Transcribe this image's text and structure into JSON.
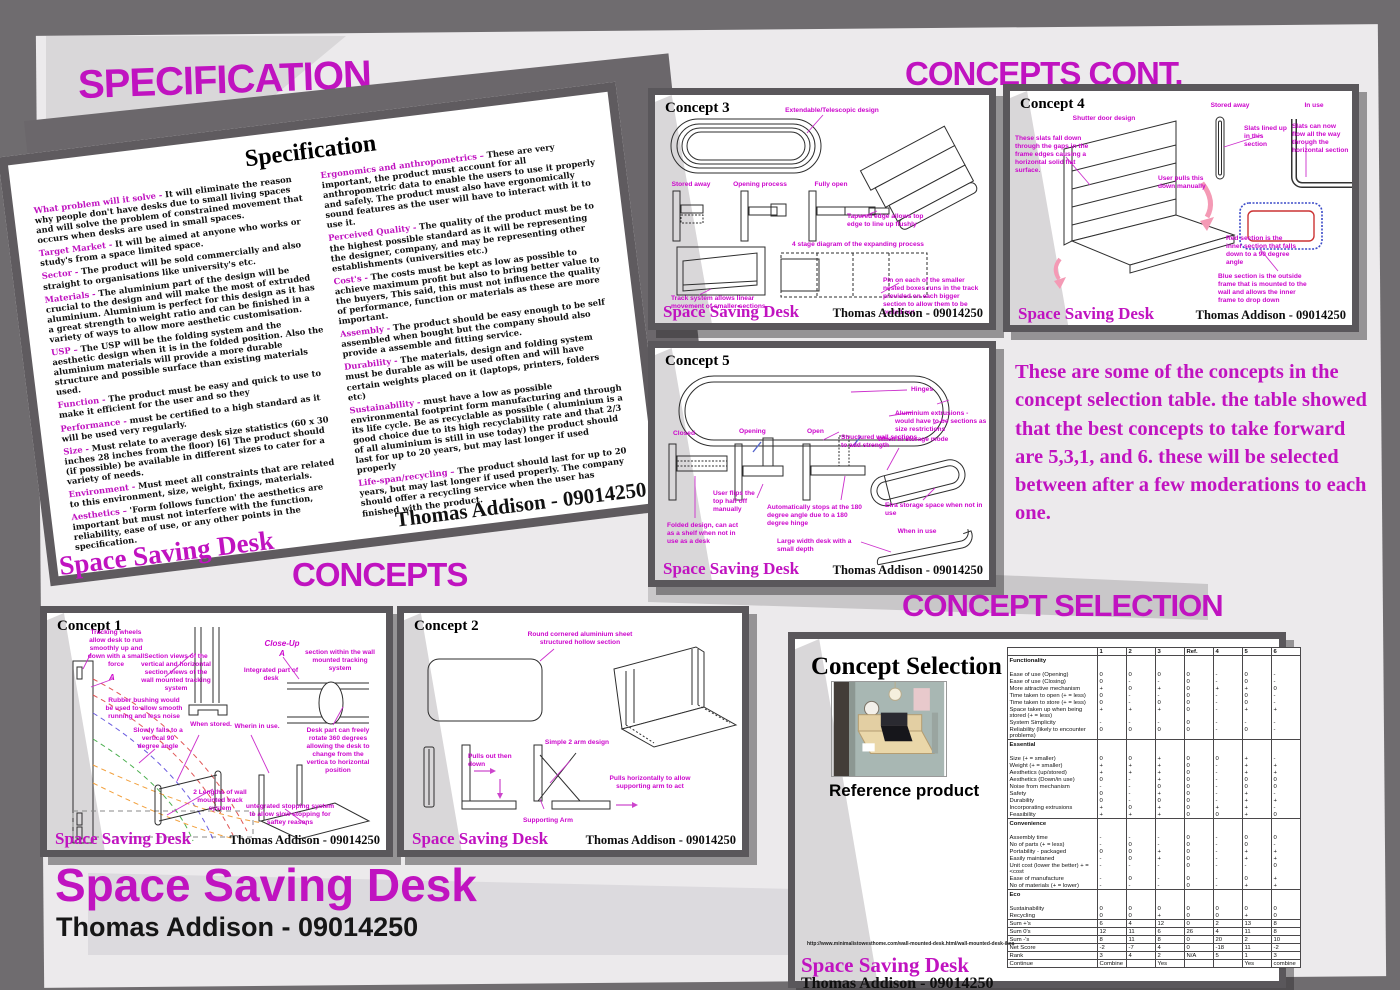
{
  "headings": {
    "specification": "SPECIFICATION",
    "concepts_cont": "CONCEPTS CONT.",
    "concepts": "CONCEPTS",
    "concept_selection": "CONCEPT SELECTION"
  },
  "poster": {
    "title": "Space Saving Desk",
    "author": "Thomas Addison - 09014250"
  },
  "panel_footer": {
    "brand": "Space Saving Desk",
    "author": "Thomas Addison - 09014250"
  },
  "colors": {
    "magenta": "#c013c0",
    "panel_border": "#5a575b",
    "background": "#6f6c6f",
    "sheet": "#eceaec"
  },
  "note": "These are some of the concepts in the concept selection table. the table showed that the best concepts to take forward are 5,3,1, and 6. these will be selected between after a few moderations to each one.",
  "spec_doc": {
    "title": "Specification",
    "left_items": [
      {
        "k": "What problem will it solve -",
        "t": "It will eliminate the reason why people don't have desks due to small living spaces and will solve the problem of constrained movement that occurs when desks are used in small spaces."
      },
      {
        "k": "Target Market -",
        "t": "It will be aimed at anyone who works or study's from a space limited space."
      },
      {
        "k": "Sector -",
        "t": "The product will be sold commercially and also straight to organisations like university's etc."
      },
      {
        "k": "Materials -",
        "t": "The aluminium part of the design will be crucial to the design and will make the most of extruded aluminium. Aluminium is perfect for this design as it has a great strength to weight ratio and can be finished in a variety of ways to allow more aesthetic customisation."
      },
      {
        "k": "USP –",
        "t": "The USP will be the folding system and the aesthetic design when it is in the folded position. Also the aluminium materials will provide a more durable structure and possible surface than existing materials used."
      },
      {
        "k": "Function -",
        "t": "The product must be easy and quick to use to make it efficient for the user and so they"
      },
      {
        "k": "Performance -",
        "t": "must be certified to a high standard as it will be used very regularly."
      },
      {
        "k": "Size -",
        "t": "Must relate to average desk size statistics (60 x 30 inches 28 inches from the floor) [6] The product should (if possible) be available in different sizes to cater for a variety of needs."
      },
      {
        "k": "Environment -",
        "t": "Must meet all constraints that are related to this environment, size, weight, fixings, materials."
      },
      {
        "k": "Aesthetics –",
        "t": "'Form follows function' the aesthetics are important but must not interfere with the function, reliability, ease of use, or any other points in the specification."
      }
    ],
    "right_items": [
      {
        "k": "Ergonomics and anthropometrics –",
        "t": "These are very important, the product must account for all anthropometric data to enable the users to use it properly and safely. The product must also have ergonomically sound features as the user will have to interact with it to use it."
      },
      {
        "k": "Perceived Quality -",
        "t": "The quality of the product must be to the highest possible standard as it will be representing the designer, company, and may be representing other establishments (universities etc.)"
      },
      {
        "k": "Cost's -",
        "t": "The costs must be kept as low as possible to achieve maximum profit but also to bring better value to the buyers, This said, this must not influence the quality of performance, function or materials as these are more important."
      },
      {
        "k": "Assembly -",
        "t": "The product should be easy enough to be self assembled when bought but the company should also provide a assemble and fitting service."
      },
      {
        "k": "Durability -",
        "t": "The materials, design and folding system must be durable as will be used often and will have certain weights placed on it (laptops, printers, folders etc)"
      },
      {
        "k": "Sustainability -",
        "t": "must have a low as possible environmental footprint form manufacturing and through its life cycle. Be as recyclable as possible ( aluminium is a good choice due to its high recyclability rate and that 2/3 of all aluminium is still in use today) the product should last for up to 20 years, but may last longer if used properly"
      },
      {
        "k": "Life-span/recycling –",
        "t": "The product should last for up to 20 years, but may last longer if used properly. The company should offer a recycling service when the user has finished with the product."
      }
    ]
  },
  "concept1": {
    "title": "Concept 1",
    "tracking": "Tracking wheels allow desk to run smoothly up and down with a small force",
    "a_label": "A",
    "rubber": "Rubber bushing would be used to allow smooth running and less noise",
    "falls": "Slowly falls to a vertical 90 degree angle",
    "section_views": "Section views of the vertical and horizontal section views of the wall mounted tracking system",
    "stored": "When stored.",
    "closeup1": "Close-Up",
    "closeup2": "A",
    "within": "section within the wall mounted tracking system",
    "integrated": "Integrated part of desk",
    "inuse": "Wherin in use.",
    "rotate": "Desk part can freely rotate 360 degrees allowing the desk to change from the vertica to horizontal position",
    "lengths": "2 Lengths of wall mounted track system",
    "stopping": "untegrated stopping system to allow slow stopping for saftey reasons"
  },
  "concept2": {
    "title": "Concept 2",
    "sheet": "Round cornered aluminium sheet structured hollow section",
    "pulls": "Pulls out then down",
    "simple": "Simple 2 arm design",
    "supporting": "Supporting Arm",
    "horizontally": "Pulls horizontally to allow supporting arm to act"
  },
  "concept3": {
    "title": "Concept 3",
    "extendable": "Extendable/Telescopic design",
    "stored": "Stored away",
    "opening": "Opening process",
    "fully": "Fully open",
    "tapered": "Tapered edge allows top edge to line up flushly",
    "stage4": "4 stage diagram of the expanding process",
    "track": "Track system allows linear movement of smaller sections",
    "pin": "Pin on each of the smaller nested boxes runs in the track provided on each bigger section to allow them to be pulled out"
  },
  "concept4": {
    "title": "Concept 4",
    "shutter": "Shutter door design",
    "slats_fall": "These slats fall down through the gaps in the frame edges causing a horizontal solid flat surface.",
    "stored": "Stored away",
    "inuse": "In use",
    "slats_lined": "Slats lined up in this section",
    "slats_flow": "Slats can now flow all the way through the horizontal section",
    "user_pulls": "User pulls this down manually",
    "red_section": "Red section is the inner section that falls down to a 90 degree angle",
    "blue_section": "Blue section is the outside frame that is mounted to the wall and allows the inner frame to drop down"
  },
  "concept5": {
    "title": "Concept 5",
    "hinges": "Hinges",
    "extrusions": "Aluminium extrusions - would have to be sections as size restrictions",
    "structured": "Structured wall sections to add strength",
    "closed": "Closed",
    "opening": "Opening",
    "open": "Open",
    "flips": "User flips the top half off manually",
    "stops": "Automatically stops at the 180 degree angle due to a 180 degree hinge",
    "folded": "Folded design, can act as a shelf when not in use as a desk",
    "storage": "When in storage mode",
    "extra": "Etra storage space when not in use",
    "inuse": "When in use",
    "width": "Large width desk with a small depth"
  },
  "selection": {
    "title": "Concept Selection",
    "caption": "Reference product",
    "url": "http://www.minimalistowesthome.com/wall-mounted-desk.html/wall-mounted-desk-ikea",
    "table": {
      "columns": [
        "1",
        "2",
        "3",
        "Ref.",
        "4",
        "5",
        "6"
      ],
      "sections": [
        {
          "name": "Functionality",
          "rows": [
            {
              "label": "Ease of use (Opening)",
              "values": [
                "0",
                "0",
                "0",
                "0",
                "-",
                "0",
                "-"
              ]
            },
            {
              "label": "Ease of use (Closing)",
              "values": [
                "0",
                "-",
                "-",
                "0",
                "-",
                "0",
                "-"
              ]
            },
            {
              "label": "More attractive mechanism",
              "values": [
                "+",
                "0",
                "+",
                "0",
                "+",
                "+",
                "0"
              ]
            },
            {
              "label": "Time taken to open (+ = less)",
              "values": [
                "0",
                "-",
                "-",
                "0",
                "-",
                "0",
                "-"
              ]
            },
            {
              "label": "Time taken to store (+ = less)",
              "values": [
                "0",
                "-",
                "0",
                "0",
                "-",
                "0",
                "-"
              ]
            },
            {
              "label": "Space taken up when being stored (+ = less)",
              "values": [
                "+",
                "+",
                "+",
                "0",
                "-",
                "+",
                "+"
              ]
            },
            {
              "label": "System Simplicity",
              "values": [
                "-",
                "-",
                "-",
                "0",
                "-",
                "-",
                "-"
              ]
            },
            {
              "label": "Reliability (likely to encounter problems)",
              "values": [
                "0",
                "0",
                "0",
                "0",
                "-",
                "0",
                "-"
              ]
            }
          ]
        },
        {
          "name": "Essential",
          "rows": [
            {
              "label": "Size (+ = smaller)",
              "values": [
                "0",
                "0",
                "+",
                "0",
                "0",
                "+",
                "-"
              ]
            },
            {
              "label": "Weight (+ = smaller)",
              "values": [
                "+",
                "+",
                "+",
                "0",
                "-",
                "+",
                "+"
              ]
            },
            {
              "label": "Aesthetics (up/stored)",
              "values": [
                "+",
                "+",
                "+",
                "0",
                "-",
                "+",
                "+"
              ]
            },
            {
              "label": "Aesthetics (Down/in use)",
              "values": [
                "0",
                "-",
                "+",
                "0",
                "-",
                "0",
                "0"
              ]
            },
            {
              "label": "Noise from mechanism",
              "values": [
                "-",
                "-",
                "0",
                "0",
                "-",
                "0",
                "0"
              ]
            },
            {
              "label": "Safety",
              "values": [
                "0",
                "-",
                "+",
                "0",
                "-",
                "+",
                "-"
              ]
            },
            {
              "label": "Durability",
              "values": [
                "0",
                "-",
                "0",
                "0",
                "-",
                "+",
                "+"
              ]
            },
            {
              "label": "Incorporating extrusions",
              "values": [
                "+",
                "0",
                "+",
                "0",
                "+",
                "+",
                "-"
              ]
            },
            {
              "label": "Feasibility",
              "values": [
                "+",
                "+",
                "+",
                "0",
                "0",
                "+",
                "0"
              ]
            }
          ]
        },
        {
          "name": "Convenience",
          "rows": [
            {
              "label": "Assembly time",
              "values": [
                "-",
                "-",
                "-",
                "0",
                "-",
                "0",
                "0"
              ]
            },
            {
              "label": "No of parts (+ = less)",
              "values": [
                "-",
                "0",
                "-",
                "0",
                "-",
                "0",
                "-"
              ]
            },
            {
              "label": "Portability - packaged",
              "values": [
                "0",
                "0",
                "+",
                "0",
                "-",
                "+",
                "+"
              ]
            },
            {
              "label": "Easily maintaned",
              "values": [
                "-",
                "0",
                "+",
                "0",
                "-",
                "+",
                "+"
              ]
            },
            {
              "label": "Unit cost (lower the better) + = <cost",
              "values": [
                "-",
                "-",
                "-",
                "0",
                "-",
                "-",
                "0"
              ]
            },
            {
              "label": "Ease of manufacture",
              "values": [
                "-",
                "0",
                "-",
                "0",
                "-",
                "0",
                "+"
              ]
            },
            {
              "label": "No of materials (+ = lower)",
              "values": [
                "-",
                "-",
                "-",
                "0",
                "-",
                "+",
                "+"
              ]
            }
          ]
        },
        {
          "name": "Eco",
          "rows": [
            {
              "label": "Sustainability",
              "values": [
                "0",
                "0",
                "0",
                "0",
                "0",
                "0",
                "0"
              ]
            },
            {
              "label": "Recycling",
              "values": [
                "0",
                "0",
                "+",
                "0",
                "0",
                "+",
                "0"
              ]
            }
          ]
        }
      ],
      "summary": [
        {
          "label": "Sum +'s",
          "values": [
            "6",
            "4",
            "12",
            "0",
            "2",
            "13",
            "8"
          ]
        },
        {
          "label": "Sum 0's",
          "values": [
            "12",
            "11",
            "6",
            "26",
            "4",
            "11",
            "8"
          ]
        },
        {
          "label": "Sum -'s",
          "values": [
            "8",
            "11",
            "8",
            "0",
            "20",
            "2",
            "10"
          ]
        },
        {
          "label": "Net Score",
          "values": [
            "-2",
            "-7",
            "4",
            "0",
            "-18",
            "11",
            "-2"
          ]
        },
        {
          "label": "Rank",
          "values": [
            "3",
            "4",
            "2",
            "N/A",
            "5",
            "1",
            "3"
          ]
        },
        {
          "label": "Continue",
          "values": [
            "Combine",
            "",
            "Yes",
            "",
            "",
            "Yes",
            "combine"
          ]
        }
      ]
    }
  }
}
